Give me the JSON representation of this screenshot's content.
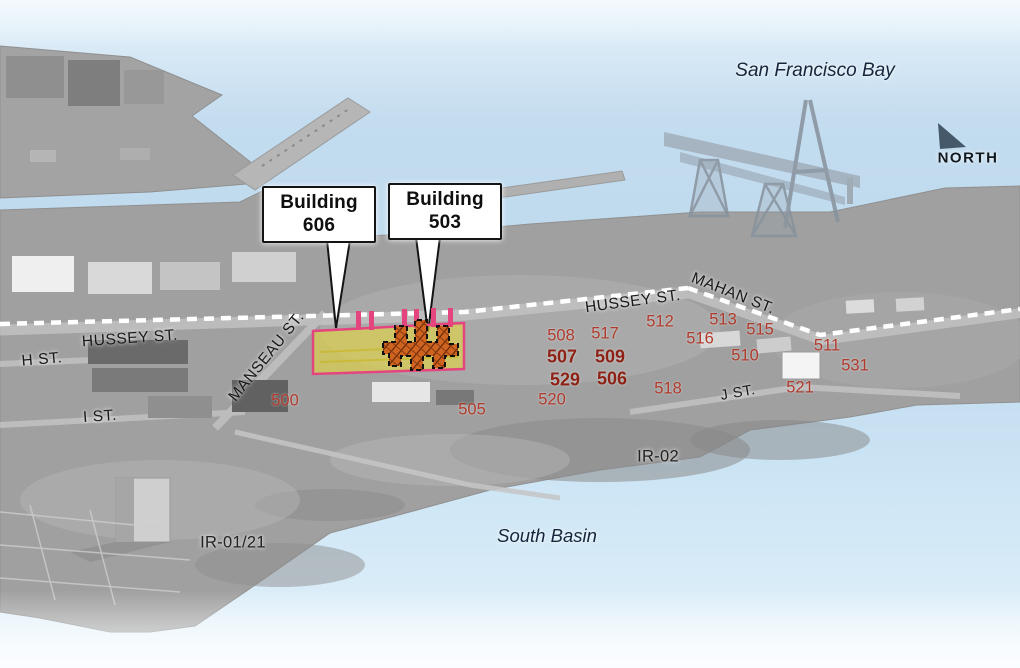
{
  "map": {
    "title_region": "San Francisco Bay",
    "north": {
      "label": "NORTH"
    },
    "water_labels": [
      {
        "label": "San Francisco Bay"
      },
      {
        "label": "South Basin"
      }
    ],
    "street_labels": [
      {
        "label": "HUSSEY ST."
      },
      {
        "label": "H ST."
      },
      {
        "label": "I ST."
      },
      {
        "label": "MANSEAU ST."
      },
      {
        "label": "HUSSEY ST."
      },
      {
        "label": "MAHAN ST."
      },
      {
        "label": "J ST."
      }
    ],
    "area_labels": [
      {
        "label": "IR-02"
      },
      {
        "label": "IR-01/21"
      }
    ],
    "callouts": [
      {
        "line1": "Building",
        "line2": "606"
      },
      {
        "line1": "Building",
        "line2": "503"
      }
    ],
    "site_numbers": [
      {
        "label": "500",
        "bold": false
      },
      {
        "label": "505",
        "bold": false
      },
      {
        "label": "508",
        "bold": false
      },
      {
        "label": "517",
        "bold": false
      },
      {
        "label": "512",
        "bold": false
      },
      {
        "label": "513",
        "bold": false
      },
      {
        "label": "516",
        "bold": false
      },
      {
        "label": "515",
        "bold": false
      },
      {
        "label": "507",
        "bold": true
      },
      {
        "label": "509",
        "bold": true
      },
      {
        "label": "510",
        "bold": false
      },
      {
        "label": "511",
        "bold": false
      },
      {
        "label": "531",
        "bold": false
      },
      {
        "label": "529",
        "bold": true
      },
      {
        "label": "506",
        "bold": true
      },
      {
        "label": "518",
        "bold": false
      },
      {
        "label": "521",
        "bold": false
      },
      {
        "label": "520",
        "bold": false
      }
    ],
    "colors": {
      "number_red": "#b03a2c",
      "number_red_bold": "#8c2114",
      "highlight_pink": "#e5457e",
      "parcel_yellow": "#e6d93c",
      "footprint_orange": "#cf6320",
      "street_dash_white": "#ffffff",
      "north_arrow": "#46596b",
      "water_blue": "#c3dcef"
    }
  }
}
